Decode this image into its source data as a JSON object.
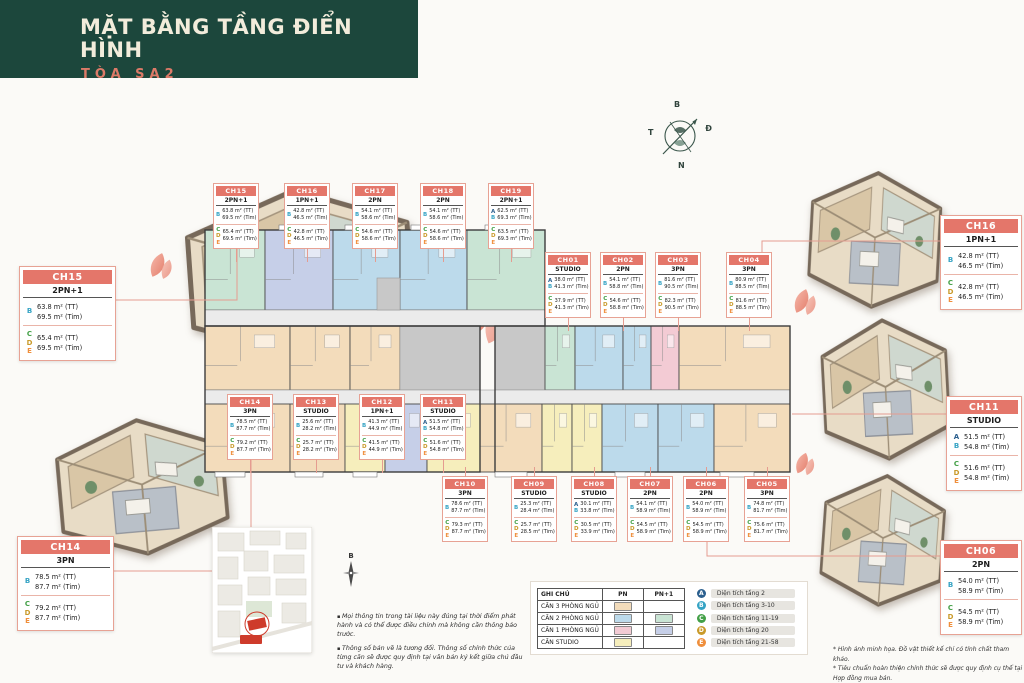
{
  "header": {
    "title": "MẶT BẰNG TẦNG ĐIỂN HÌNH",
    "subtitle": "TÒA SA2"
  },
  "compass": {
    "north": "B",
    "east": "Đ",
    "south": "N",
    "west": "T"
  },
  "compass_small": "B",
  "floor_levels": [
    {
      "letter": "A",
      "color": "#2b5f8e",
      "label": "Diện tích tầng 2"
    },
    {
      "letter": "B",
      "color": "#35a3c4",
      "label": "Diện tích tầng 3-10"
    },
    {
      "letter": "C",
      "color": "#43a047",
      "label": "Diện tích tầng 11-19"
    },
    {
      "letter": "D",
      "color": "#c99a2a",
      "label": "Diện tích tầng 20"
    },
    {
      "letter": "E",
      "color": "#ef8f3c",
      "label": "Diện tích tầng 21-58"
    }
  ],
  "type_colors": {
    "3PN": "#f3dcbb",
    "2PN": "#bcdaeb",
    "2PN+1": "#c9e4d4",
    "1PN": "#f3cbd4",
    "1PN+1": "#c6cfe8",
    "STUDIO": "#f6eebc",
    "core": "#c8c8c8",
    "corridor": "#ebebeb"
  },
  "legend_table": {
    "headers": [
      "GHI CHÚ",
      "PN",
      "PN+1"
    ],
    "rows": [
      {
        "label": "CĂN 3 PHÒNG NGỦ",
        "pn": "#f3dcbb",
        "pn1": ""
      },
      {
        "label": "CĂN 2 PHÒNG NGỦ",
        "pn": "#bcdaeb",
        "pn1": "#c9e4d4"
      },
      {
        "label": "CĂN 1 PHÒNG NGỦ",
        "pn": "#f3cbd4",
        "pn1": "#c6cfe8"
      },
      {
        "label": "CĂN STUDIO",
        "pn": "#f6eebc",
        "pn1": ""
      }
    ]
  },
  "units": [
    {
      "id": "CH15",
      "type": "2PN+1",
      "x": 213,
      "y": 183,
      "stub": "down",
      "groups": [
        {
          "letters": [
            "B"
          ],
          "tt": "63.8 m² (TT)",
          "tim": "69.5 m² (Tim)"
        },
        {
          "letters": [
            "C",
            "D",
            "E"
          ],
          "tt": "65.4 m² (TT)",
          "tim": "69.5 m² (Tim)"
        }
      ]
    },
    {
      "id": "CH16",
      "type": "1PN+1",
      "x": 284,
      "y": 183,
      "stub": "down",
      "groups": [
        {
          "letters": [
            "B"
          ],
          "tt": "42.8 m² (TT)",
          "tim": "46.5 m² (Tim)"
        },
        {
          "letters": [
            "C",
            "D",
            "E"
          ],
          "tt": "42.8 m² (TT)",
          "tim": "46.5 m² (Tim)"
        }
      ]
    },
    {
      "id": "CH17",
      "type": "2PN",
      "x": 352,
      "y": 183,
      "stub": "down",
      "groups": [
        {
          "letters": [
            "B"
          ],
          "tt": "54.1 m² (TT)",
          "tim": "58.6 m² (Tim)"
        },
        {
          "letters": [
            "C",
            "D",
            "E"
          ],
          "tt": "54.6 m² (TT)",
          "tim": "58.6 m² (Tim)"
        }
      ]
    },
    {
      "id": "CH18",
      "type": "2PN",
      "x": 420,
      "y": 183,
      "stub": "down",
      "groups": [
        {
          "letters": [
            "B"
          ],
          "tt": "54.1 m² (TT)",
          "tim": "58.6 m² (Tim)"
        },
        {
          "letters": [
            "C",
            "D",
            "E"
          ],
          "tt": "54.6 m² (TT)",
          "tim": "58.6 m² (Tim)"
        }
      ]
    },
    {
      "id": "CH19",
      "type": "2PN+1",
      "x": 488,
      "y": 183,
      "stub": "down",
      "groups": [
        {
          "letters": [
            "A",
            "B"
          ],
          "tt": "62.5 m² (TT)",
          "tim": "69.3 m² (Tim)"
        },
        {
          "letters": [
            "C",
            "D",
            "E"
          ],
          "tt": "63.5 m² (TT)",
          "tim": "69.3 m² (Tim)"
        }
      ]
    },
    {
      "id": "CH01",
      "type": "STUDIO",
      "x": 545,
      "y": 252,
      "stub": "down",
      "groups": [
        {
          "letters": [
            "A",
            "B"
          ],
          "tt": "38.0 m² (TT)",
          "tim": "41.3 m² (Tim)"
        },
        {
          "letters": [
            "C",
            "D",
            "E"
          ],
          "tt": "37.9 m² (TT)",
          "tim": "41.3 m² (Tim)"
        }
      ]
    },
    {
      "id": "CH02",
      "type": "2PN",
      "x": 600,
      "y": 252,
      "stub": "down",
      "groups": [
        {
          "letters": [
            "B"
          ],
          "tt": "54.1 m² (TT)",
          "tim": "58.8 m² (Tim)"
        },
        {
          "letters": [
            "C",
            "D",
            "E"
          ],
          "tt": "54.6 m² (TT)",
          "tim": "58.8 m² (Tim)"
        }
      ]
    },
    {
      "id": "CH03",
      "type": "3PN",
      "x": 655,
      "y": 252,
      "stub": "down",
      "groups": [
        {
          "letters": [
            "B"
          ],
          "tt": "81.6 m² (TT)",
          "tim": "90.5 m² (Tim)"
        },
        {
          "letters": [
            "C",
            "D",
            "E"
          ],
          "tt": "82.3 m² (TT)",
          "tim": "90.5 m² (Tim)"
        }
      ]
    },
    {
      "id": "CH04",
      "type": "3PN",
      "x": 726,
      "y": 252,
      "stub": "down",
      "groups": [
        {
          "letters": [
            "B"
          ],
          "tt": "80.9 m² (TT)",
          "tim": "88.5 m² (Tim)"
        },
        {
          "letters": [
            "C",
            "D",
            "E"
          ],
          "tt": "81.6 m² (TT)",
          "tim": "88.5 m² (Tim)"
        }
      ]
    },
    {
      "id": "CH14",
      "type": "3PN",
      "x": 227,
      "y": 394,
      "stub": "down",
      "groups": [
        {
          "letters": [
            "B"
          ],
          "tt": "78.5 m² (TT)",
          "tim": "87.7 m² (Tim)"
        },
        {
          "letters": [
            "C",
            "D",
            "E"
          ],
          "tt": "79.2 m² (TT)",
          "tim": "87.7 m² (Tim)"
        }
      ]
    },
    {
      "id": "CH13",
      "type": "STUDIO",
      "x": 293,
      "y": 394,
      "stub": "down",
      "groups": [
        {
          "letters": [
            "B"
          ],
          "tt": "25.6 m² (TT)",
          "tim": "28.2 m² (Tim)"
        },
        {
          "letters": [
            "C",
            "D",
            "E"
          ],
          "tt": "25.7 m² (TT)",
          "tim": "28.2 m² (Tim)"
        }
      ]
    },
    {
      "id": "CH12",
      "type": "1PN+1",
      "x": 359,
      "y": 394,
      "stub": "down",
      "groups": [
        {
          "letters": [
            "B"
          ],
          "tt": "41.3 m² (TT)",
          "tim": "44.9 m² (Tim)"
        },
        {
          "letters": [
            "C",
            "D",
            "E"
          ],
          "tt": "41.5 m² (TT)",
          "tim": "44.9 m² (Tim)"
        }
      ]
    },
    {
      "id": "CH11",
      "type": "STUDIO",
      "x": 420,
      "y": 394,
      "stub": "down",
      "groups": [
        {
          "letters": [
            "A",
            "B"
          ],
          "tt": "51.5 m² (TT)",
          "tim": "54.8 m² (Tim)"
        },
        {
          "letters": [
            "C",
            "D",
            "E"
          ],
          "tt": "51.6 m² (TT)",
          "tim": "54.8 m² (Tim)"
        }
      ]
    },
    {
      "id": "CH10",
      "type": "3PN",
      "x": 442,
      "y": 476,
      "stub": "up",
      "groups": [
        {
          "letters": [
            "B"
          ],
          "tt": "78.6 m² (TT)",
          "tim": "87.7 m² (Tim)"
        },
        {
          "letters": [
            "C",
            "D",
            "E"
          ],
          "tt": "79.3 m² (TT)",
          "tim": "87.7 m² (Tim)"
        }
      ]
    },
    {
      "id": "CH09",
      "type": "STUDIO",
      "x": 511,
      "y": 476,
      "stub": "up",
      "groups": [
        {
          "letters": [
            "B"
          ],
          "tt": "25.3 m² (TT)",
          "tim": "28.4 m² (Tim)"
        },
        {
          "letters": [
            "C",
            "D",
            "E"
          ],
          "tt": "25.7 m² (TT)",
          "tim": "28.5 m² (Tim)"
        }
      ]
    },
    {
      "id": "CH08",
      "type": "STUDIO",
      "x": 571,
      "y": 476,
      "stub": "up",
      "groups": [
        {
          "letters": [
            "A",
            "B"
          ],
          "tt": "30.1 m² (TT)",
          "tim": "33.8 m² (Tim)"
        },
        {
          "letters": [
            "C",
            "D",
            "E"
          ],
          "tt": "30.5 m² (TT)",
          "tim": "33.9 m² (Tim)"
        }
      ]
    },
    {
      "id": "CH07",
      "type": "2PN",
      "x": 627,
      "y": 476,
      "stub": "up",
      "groups": [
        {
          "letters": [
            "B"
          ],
          "tt": "54.1 m² (TT)",
          "tim": "58.9 m² (Tim)"
        },
        {
          "letters": [
            "C",
            "D",
            "E"
          ],
          "tt": "54.5 m² (TT)",
          "tim": "58.9 m² (Tim)"
        }
      ]
    },
    {
      "id": "CH06",
      "type": "2PN",
      "x": 683,
      "y": 476,
      "stub": "up",
      "groups": [
        {
          "letters": [
            "B"
          ],
          "tt": "54.0 m² (TT)",
          "tim": "58.9 m² (Tim)"
        },
        {
          "letters": [
            "C",
            "D",
            "E"
          ],
          "tt": "54.5 m² (TT)",
          "tim": "58.9 m² (Tim)"
        }
      ]
    },
    {
      "id": "CH05",
      "type": "3PN",
      "x": 744,
      "y": 476,
      "stub": "up",
      "groups": [
        {
          "letters": [
            "B"
          ],
          "tt": "74.8 m² (TT)",
          "tim": "81.7 m² (Tim)"
        },
        {
          "letters": [
            "C",
            "D",
            "E"
          ],
          "tt": "75.6 m² (TT)",
          "tim": "81.7 m² (Tim)"
        }
      ]
    }
  ],
  "featured": [
    {
      "id": "CH15",
      "type": "2PN+1",
      "x": 19,
      "y": 266,
      "w": 97,
      "groups": [
        {
          "letters": [
            "B"
          ],
          "tt": "63.8 m² (TT)",
          "tim": "69.5 m² (Tim)"
        },
        {
          "letters": [
            "C",
            "D",
            "E"
          ],
          "tt": "65.4 m² (TT)",
          "tim": "69.5 m² (Tim)"
        }
      ]
    },
    {
      "id": "CH16",
      "type": "1PN+1",
      "x": 940,
      "y": 215,
      "w": 82,
      "groups": [
        {
          "letters": [
            "B"
          ],
          "tt": "42.8 m² (TT)",
          "tim": "46.5 m² (Tim)"
        },
        {
          "letters": [
            "C",
            "D",
            "E"
          ],
          "tt": "42.8 m² (TT)",
          "tim": "46.5 m² (Tim)"
        }
      ]
    },
    {
      "id": "CH11",
      "type": "STUDIO",
      "x": 946,
      "y": 396,
      "w": 76,
      "groups": [
        {
          "letters": [
            "A",
            "B"
          ],
          "tt": "51.5 m² (TT)",
          "tim": "54.8 m² (Tim)"
        },
        {
          "letters": [
            "C",
            "D",
            "E"
          ],
          "tt": "51.6 m² (TT)",
          "tim": "54.8 m² (Tim)"
        }
      ]
    },
    {
      "id": "CH06",
      "type": "2PN",
      "x": 940,
      "y": 540,
      "w": 82,
      "groups": [
        {
          "letters": [
            "B"
          ],
          "tt": "54.0 m² (TT)",
          "tim": "58.9 m² (Tim)"
        },
        {
          "letters": [
            "C",
            "D",
            "E"
          ],
          "tt": "54.5 m² (TT)",
          "tim": "58.9 m² (Tim)"
        }
      ]
    },
    {
      "id": "CH14",
      "type": "3PN",
      "x": 17,
      "y": 536,
      "w": 97,
      "groups": [
        {
          "letters": [
            "B"
          ],
          "tt": "78.5 m² (TT)",
          "tim": "87.7 m² (Tim)"
        },
        {
          "letters": [
            "C",
            "D",
            "E"
          ],
          "tt": "79.2 m² (TT)",
          "tim": "87.7 m² (Tim)"
        }
      ]
    }
  ],
  "notes_left": [
    "Mọi thông tin trong tài liệu này đúng tại thời điểm phát hành và có thể được điều chỉnh mà không cần thông báo trước.",
    "Thông số bản vẽ là tương đối. Thông số chính thức của từng căn sẽ được quy định tại văn bản ký kết giữa chủ đầu tư và khách hàng."
  ],
  "footnotes_right": [
    "* Hình ảnh minh họa. Đồ vật thiết kế chỉ có tính chất tham khảo.",
    "* Tiêu chuẩn hoàn thiện chính thức sẽ được quy định cụ thể tại Hợp đồng mua bán."
  ]
}
